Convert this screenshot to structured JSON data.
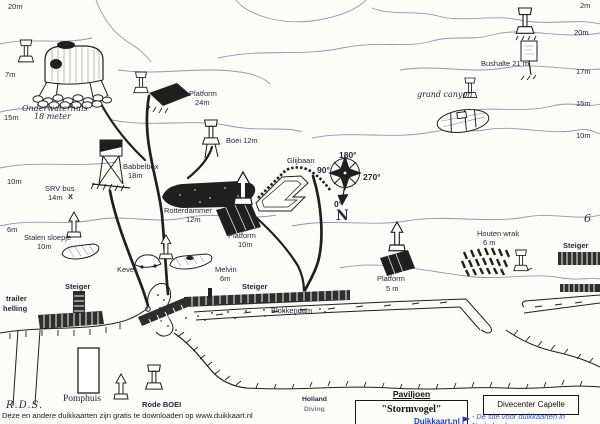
{
  "title": "Duikkaart (dive map) - hand drawn scanned site map",
  "colors": {
    "paper": "#fcfcf9",
    "ink": "#1f1f1f",
    "contour": "#9097ad",
    "label_ink": "#26263c",
    "dock_fill": "#2e2e2e",
    "brand_blue": "#1c3ed6"
  },
  "labels": [
    {
      "name": "depth-20m-left",
      "text": "20m",
      "x": 8,
      "y": 3,
      "cls": ""
    },
    {
      "name": "depth-7m-left",
      "text": "7m",
      "x": 5,
      "y": 71,
      "cls": ""
    },
    {
      "name": "depth-15m-left",
      "text": "15m",
      "x": 4,
      "y": 114,
      "cls": ""
    },
    {
      "name": "depth-10m-left",
      "text": "10m",
      "x": 7,
      "y": 178,
      "cls": ""
    },
    {
      "name": "depth-6m-left",
      "text": "6m",
      "x": 7,
      "y": 226,
      "cls": ""
    },
    {
      "name": "depth-2m-right",
      "text": "2m",
      "x": 580,
      "y": 2,
      "cls": ""
    },
    {
      "name": "depth-20m-right",
      "text": "20m",
      "x": 574,
      "y": 29,
      "cls": ""
    },
    {
      "name": "depth-17m-right",
      "text": "17m",
      "x": 576,
      "y": 68,
      "cls": ""
    },
    {
      "name": "depth-15m-right",
      "text": "15m",
      "x": 576,
      "y": 100,
      "cls": ""
    },
    {
      "name": "depth-10m-right",
      "text": "10m",
      "x": 576,
      "y": 132,
      "cls": ""
    },
    {
      "name": "depth-6-right",
      "text": "6",
      "x": 584,
      "y": 212,
      "cls": "scr"
    },
    {
      "name": "label-onderwaterhuis",
      "text": "Onderwaterhuis",
      "x": 22,
      "y": 104,
      "cls": "hand"
    },
    {
      "name": "label-onderwaterhuis-depth",
      "text": "18 meter",
      "x": 34,
      "y": 112,
      "cls": "hand"
    },
    {
      "name": "label-platform-24m",
      "text": "Platform",
      "x": 189,
      "y": 90,
      "cls": ""
    },
    {
      "name": "label-platform-24m-depth",
      "text": "24m",
      "x": 195,
      "y": 99,
      "cls": ""
    },
    {
      "name": "label-boei-12m",
      "text": "Boei 12m",
      "x": 226,
      "y": 137,
      "cls": ""
    },
    {
      "name": "label-bushalte-21m",
      "text": "Bushalte 21 m",
      "x": 481,
      "y": 60,
      "cls": ""
    },
    {
      "name": "label-grand-canyon",
      "text": "grand canyon",
      "x": 417,
      "y": 90,
      "cls": "hand"
    },
    {
      "name": "label-babbelbox",
      "text": "Babbelbox",
      "x": 123,
      "y": 163,
      "cls": ""
    },
    {
      "name": "label-babbelbox-depth",
      "text": "18m",
      "x": 128,
      "y": 172,
      "cls": ""
    },
    {
      "name": "label-srv-bus",
      "text": "SRV bus",
      "x": 45,
      "y": 185,
      "cls": ""
    },
    {
      "name": "label-srv-bus-depth",
      "text": "14m",
      "x": 48,
      "y": 194,
      "cls": ""
    },
    {
      "name": "label-srv-bus-x",
      "text": "X",
      "x": 68,
      "y": 193,
      "cls": "b"
    },
    {
      "name": "label-glijbaan",
      "text": "Glijbaan",
      "x": 287,
      "y": 157,
      "cls": ""
    },
    {
      "name": "compass-180",
      "text": "180°",
      "x": 339,
      "y": 151,
      "cls": "deg"
    },
    {
      "name": "compass-90",
      "text": "90°",
      "x": 317,
      "y": 166,
      "cls": "deg"
    },
    {
      "name": "compass-270",
      "text": "270°",
      "x": 363,
      "y": 173,
      "cls": "deg"
    },
    {
      "name": "compass-0",
      "text": "0°",
      "x": 334,
      "y": 200,
      "cls": "deg"
    },
    {
      "name": "compass-n",
      "text": "N",
      "x": 336,
      "y": 208,
      "cls": "north"
    },
    {
      "name": "label-rotterdammer",
      "text": "Rotterdammer",
      "x": 164,
      "y": 207,
      "cls": ""
    },
    {
      "name": "label-rotterdammer-depth",
      "text": "12m",
      "x": 186,
      "y": 216,
      "cls": ""
    },
    {
      "name": "label-platform-10m",
      "text": "Platform",
      "x": 228,
      "y": 232,
      "cls": ""
    },
    {
      "name": "label-platform-10m-depth",
      "text": "10m",
      "x": 238,
      "y": 241,
      "cls": ""
    },
    {
      "name": "label-stalen-sloepje",
      "text": "Stalen sloepje",
      "x": 24,
      "y": 234,
      "cls": ""
    },
    {
      "name": "label-stalen-sloepje-depth",
      "text": "10m",
      "x": 37,
      "y": 243,
      "cls": ""
    },
    {
      "name": "label-kever",
      "text": "Kever",
      "x": 117,
      "y": 266,
      "cls": ""
    },
    {
      "name": "label-melvin",
      "text": "Melvin",
      "x": 215,
      "y": 266,
      "cls": ""
    },
    {
      "name": "label-melvin-depth",
      "text": "6m",
      "x": 220,
      "y": 275,
      "cls": ""
    },
    {
      "name": "label-platform-5m",
      "text": "Platform",
      "x": 377,
      "y": 275,
      "cls": ""
    },
    {
      "name": "label-platform-5m-depth",
      "text": "5 m",
      "x": 386,
      "y": 285,
      "cls": ""
    },
    {
      "name": "label-houten-wrak",
      "text": "Houten wrak",
      "x": 477,
      "y": 230,
      "cls": ""
    },
    {
      "name": "label-houten-wrak-depth",
      "text": "6 m",
      "x": 483,
      "y": 239,
      "cls": ""
    },
    {
      "name": "label-steiger-right",
      "text": "Steiger",
      "x": 563,
      "y": 242,
      "cls": "b"
    },
    {
      "name": "label-steiger-vertical",
      "text": "Steiger",
      "x": 65,
      "y": 283,
      "cls": "b"
    },
    {
      "name": "label-steiger-long",
      "text": "Steiger",
      "x": 242,
      "y": 283,
      "cls": "b"
    },
    {
      "name": "label-blokkendam",
      "text": "Blokkendam",
      "x": 271,
      "y": 307,
      "cls": ""
    },
    {
      "name": "label-trailer-helling-1",
      "text": "trailer",
      "x": 6,
      "y": 295,
      "cls": "b"
    },
    {
      "name": "label-trailer-helling-2",
      "text": "helling",
      "x": 3,
      "y": 305,
      "cls": "b"
    },
    {
      "name": "label-pomphuis",
      "text": "Pomphuis",
      "x": 63,
      "y": 394,
      "cls": "serif"
    },
    {
      "name": "label-rode-boei",
      "text": "Rode BOEI",
      "x": 142,
      "y": 401,
      "cls": "b"
    },
    {
      "name": "signature-rds",
      "text": "R.D.S.",
      "x": 6,
      "y": 400,
      "cls": "sig"
    },
    {
      "name": "label-holland-1",
      "text": "Holland",
      "x": 302,
      "y": 396,
      "cls": "tinyb"
    },
    {
      "name": "label-holland-2",
      "text": "Diving",
      "x": 304,
      "y": 406,
      "cls": "tinyb cut"
    }
  ],
  "buildings": {
    "paviljoen_title": "Paviljoen",
    "paviljoen_name": "\"Stormvogel\"",
    "divecenter": "Divecenter Capelle"
  },
  "footer": {
    "credit": "Deze en andere duikkaarten zijn gratis te downloaden op www.duikkaart.nl",
    "brand": "Duikkaart.nl",
    "tagline": "- Dé site voor duikkaarten in Nederland"
  }
}
